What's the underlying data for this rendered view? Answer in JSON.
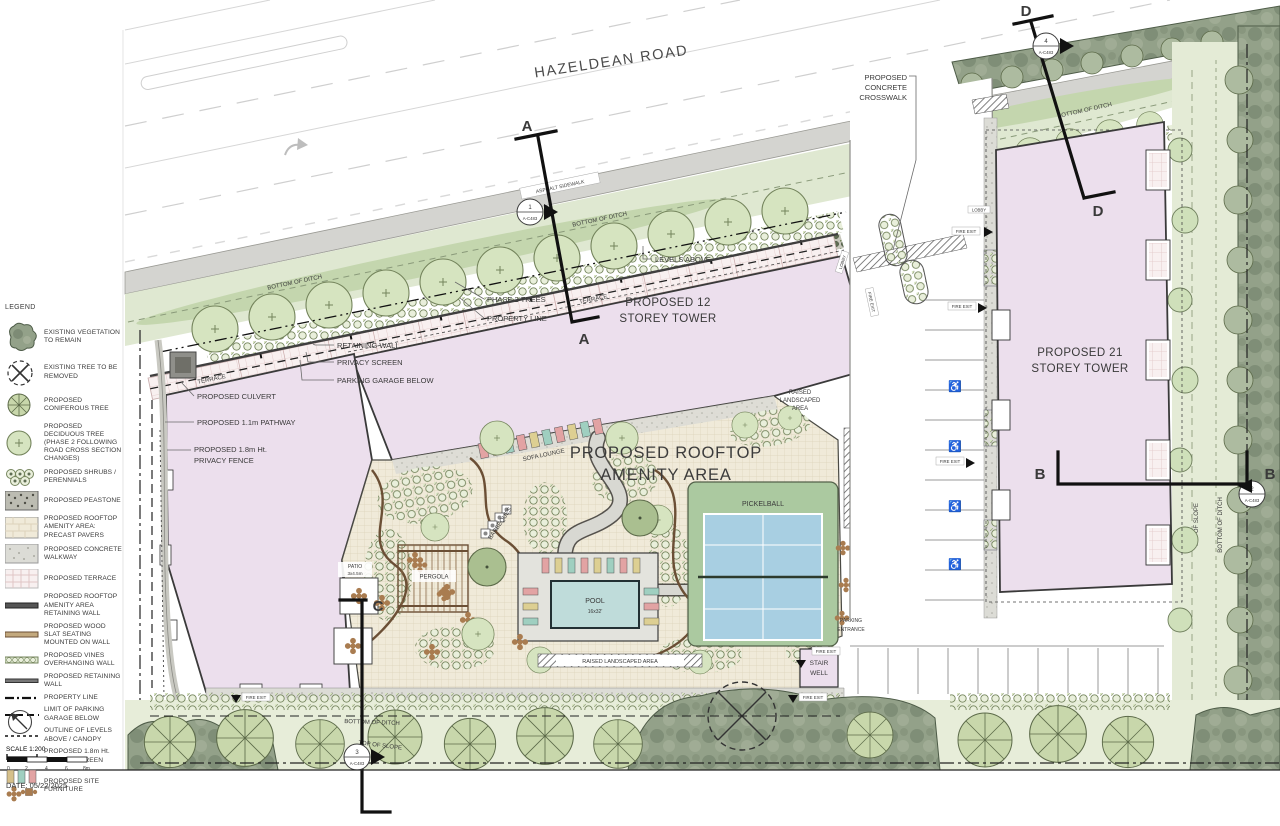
{
  "road": {
    "name": "HAZELDEAN ROAD",
    "sidewalk": "ASPHALT SIDEWALK"
  },
  "ditch": {
    "bottom": "BOTTOM OF DITCH",
    "top_of_slope": "TOP OF SLOPE"
  },
  "towers": {
    "t12a": "PROPOSED 12",
    "t12b": "STOREY TOWER",
    "t21a": "PROPOSED 21",
    "t21b": "STOREY TOWER"
  },
  "amenity": {
    "t1": "PROPOSED ROOFTOP",
    "t2": "AMENITY AREA",
    "pool": "POOL",
    "pool_size": "16x32'",
    "pickleball": "PICKELBALL",
    "pergola": "PERGOLA",
    "patio": "PATIO",
    "patio_size": "3x4.5m",
    "sofa": "SOFA LOUNGE",
    "bbq": "BARBEQUES",
    "raised1": "RAISED",
    "raised2": "LANDSCAPED",
    "raised3": "AREA",
    "raised_b": "RAISED LANDSCAPED AREA"
  },
  "callouts": {
    "crosswalk1": "PROPOSED",
    "crosswalk2": "CONCRETE",
    "crosswalk3": "CROSSWALK",
    "levels": "LEVELS ABOVE",
    "phase2": "PHASE 2 TREES",
    "prop": "PROPERTY LINE",
    "retain": "RETAINING WALL",
    "pscreen": "PRIVACY SCREEN",
    "garage": "PARKING GARAGE BELOW",
    "culvert": "PROPOSED CULVERT",
    "pathway": "PROPOSED 1.1m PATHWAY",
    "fence1": "PROPOSED 1.8m Ht.",
    "fence2": "PRIVACY FENCE"
  },
  "site": {
    "terrace": "TERRACE",
    "stair1": "STAIR",
    "stair2": "WELL",
    "fire": "FIRE EXIT",
    "lobby": "LOBBY",
    "park1": "PARKING",
    "park2": "ENTRANCE"
  },
  "sections": {
    "a": "A",
    "b": "B",
    "c": "C",
    "d": "D"
  },
  "details": {
    "ref": "A-C483",
    "n1": "1",
    "n2": "2",
    "n3": "3",
    "n4": "4"
  },
  "legend": {
    "header": "LEGEND",
    "items": [
      {
        "label": "EXISTING VEGETATION TO REMAIN"
      },
      {
        "label": "EXISTING TREE TO BE REMOVED"
      },
      {
        "label": "PROPOSED CONIFEROUS TREE"
      },
      {
        "label": "PROPOSED DECIDUOUS TREE (PHASE 2 FOLLOWING ROAD CROSS SECTION CHANGES)"
      },
      {
        "label": "PROPOSED SHRUBS / PERENNIALS"
      },
      {
        "label": "PROPOSED PEASTONE"
      },
      {
        "label": "PROPOSED ROOFTOP AMENITY AREA: PRECAST PAVERS"
      },
      {
        "label": "PROPOSED CONCRETE WALKWAY"
      },
      {
        "label": "PROPOSED TERRACE"
      },
      {
        "label": "PROPOSED ROOFTOP AMENITY AREA RETAINING WALL"
      },
      {
        "label": "PROPOSED WOOD SLAT SEATING MOUNTED ON WALL"
      },
      {
        "label": "PROPOSED VINES OVERHANGING WALL"
      },
      {
        "label": "PROPOSED RETAINING WALL"
      },
      {
        "label": "PROPERTY LINE"
      },
      {
        "label": "LIMIT OF PARKING GARAGE BELOW"
      },
      {
        "label": "OUTLINE OF LEVELS ABOVE / CANOPY"
      },
      {
        "label": "PROPOSED 1.8m Ht. PRIVACY SCREEN"
      },
      {
        "label": "PROPOSED SITE FURNITURE"
      }
    ],
    "scale": "SCALE 1:200",
    "ticks": [
      "0",
      "2",
      "4",
      "6",
      "8m"
    ]
  },
  "footer": {
    "date": "DATE: 05/22/2025"
  },
  "colors": {
    "building": "#ecdfed",
    "water": "#bfdcda",
    "court_green": "#abc9a0",
    "court_blue": "#a8cfe2",
    "ditch_green": "#dfe8d1",
    "veg_dark": "#93a189"
  }
}
